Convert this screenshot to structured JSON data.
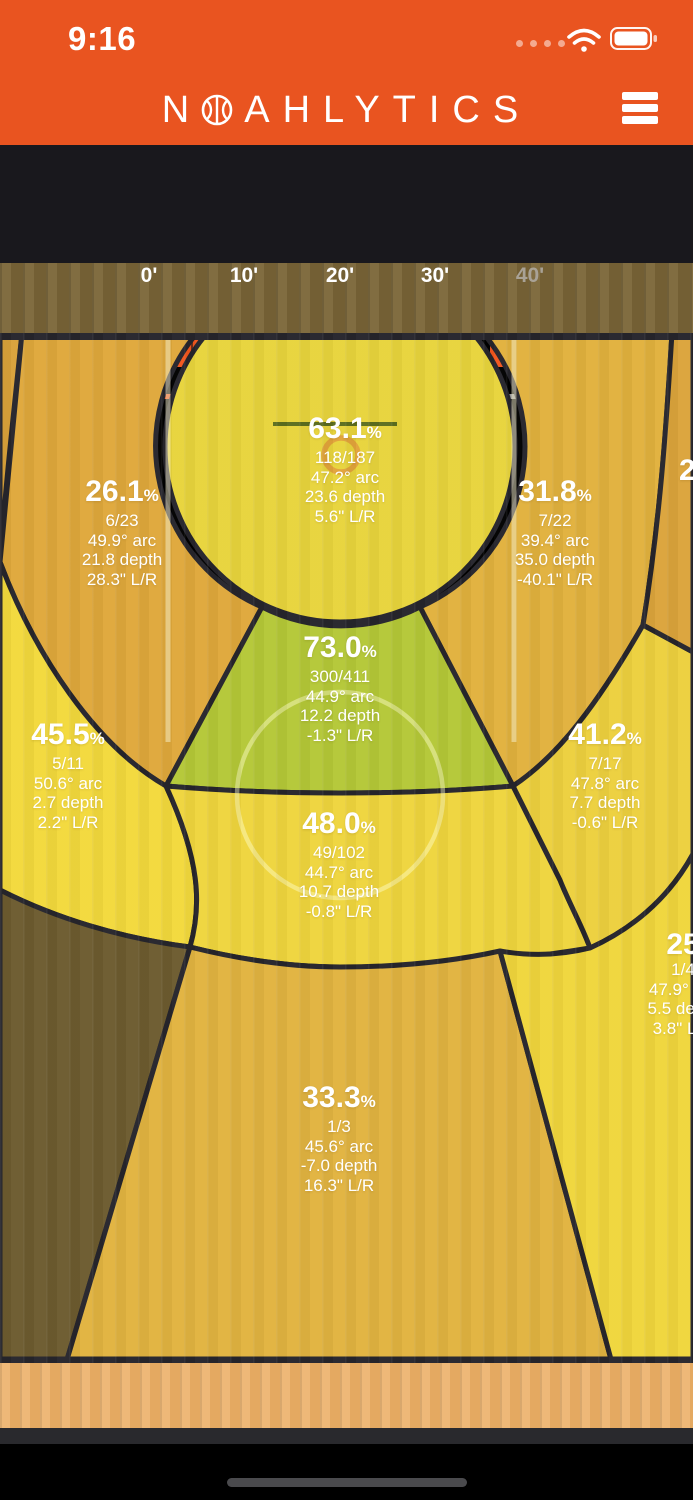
{
  "status_bar": {
    "time": "9:16"
  },
  "header": {
    "brand_first": "N",
    "brand_rest": "AHLYTICS",
    "brand_full": "NOAHLYTICS"
  },
  "toolbar": {
    "buttons": [
      {
        "id": "panels",
        "icon": "ellipsis-card-icon",
        "active": false
      },
      {
        "id": "streak",
        "icon": "flame-icon",
        "active": false
      },
      {
        "id": "target",
        "icon": "target-icon",
        "active": false
      },
      {
        "id": "list",
        "icon": "list-icon",
        "active": true
      },
      {
        "id": "calendar",
        "icon": "calendar-icon",
        "active": false
      },
      {
        "id": "player",
        "icon": "person-icon",
        "active": false
      },
      {
        "id": "location",
        "icon": "location-pin-icon",
        "active": false
      },
      {
        "id": "settings",
        "icon": "wrench-icon",
        "active": false
      }
    ]
  },
  "distance_slider": {
    "labels": [
      "0'",
      "10'",
      "20'",
      "30'",
      "40'"
    ],
    "range_start": "0'",
    "range_end": "30'"
  },
  "colors": {
    "header_orange": "#E95420",
    "accent_orange": "#F2561D",
    "toolbar_bg": "#19181D",
    "zone_stroke": "#26252C",
    "green_zone": "#B4C837"
  },
  "zones": [
    {
      "name": "close-range-circle",
      "color": "#E8D43C",
      "pct": "63.1",
      "pct_sign": "%",
      "made": "118/187",
      "arc": "47.2° arc",
      "depth": "23.6 depth",
      "lr": "5.6\" L/R"
    },
    {
      "name": "upper-left",
      "color": "#DFA83B",
      "pct": "26.1",
      "pct_sign": "%",
      "made": "6/23",
      "arc": "49.9° arc",
      "depth": "21.8 depth",
      "lr": "28.3\" L/R"
    },
    {
      "name": "upper-right",
      "color": "#E1B13D",
      "pct": "31.8",
      "pct_sign": "%",
      "made": "7/22",
      "arc": "39.4° arc",
      "depth": "35.0 depth",
      "lr": "-40.1\" L/R"
    },
    {
      "name": "key-green",
      "color": "#B4C837",
      "pct": "73.0",
      "pct_sign": "%",
      "made": "300/411",
      "arc": "44.9° arc",
      "depth": "12.2 depth",
      "lr": "-1.3\" L/R"
    },
    {
      "name": "mid-left",
      "color": "#F3D93C",
      "pct": "45.5",
      "pct_sign": "%",
      "made": "5/11",
      "arc": "50.6° arc",
      "depth": "2.7 depth",
      "lr": "2.2\" L/R"
    },
    {
      "name": "mid-right",
      "color": "#EDD03E",
      "pct": "41.2",
      "pct_sign": "%",
      "made": "7/17",
      "arc": "47.8° arc",
      "depth": "7.7 depth",
      "lr": "-0.6\" L/R"
    },
    {
      "name": "mid-center",
      "color": "#EFD53D",
      "pct": "48.0",
      "pct_sign": "%",
      "made": "49/102",
      "arc": "44.7° arc",
      "depth": "10.7 depth",
      "lr": "-0.8\" L/R"
    },
    {
      "name": "deep-center",
      "color": "#E1B340",
      "pct": "33.3",
      "pct_sign": "%",
      "made": "1/3",
      "arc": "45.6° arc",
      "depth": "-7.0 depth",
      "lr": "16.3\" L/R"
    },
    {
      "name": "deep-right-partial",
      "color": "#F0D63C",
      "pct": "25",
      "made": "1/4",
      "arc": "47.9° arc",
      "depth": "5.5 depth",
      "lr": "3.8\" L/R"
    },
    {
      "name": "corner-right-partial",
      "color": "#DBA43B",
      "pct": "2"
    },
    {
      "name": "corner-left-sliver",
      "color": "#D9A23A"
    },
    {
      "name": "deep-left-olive",
      "color": "#6D5B2F"
    }
  ]
}
